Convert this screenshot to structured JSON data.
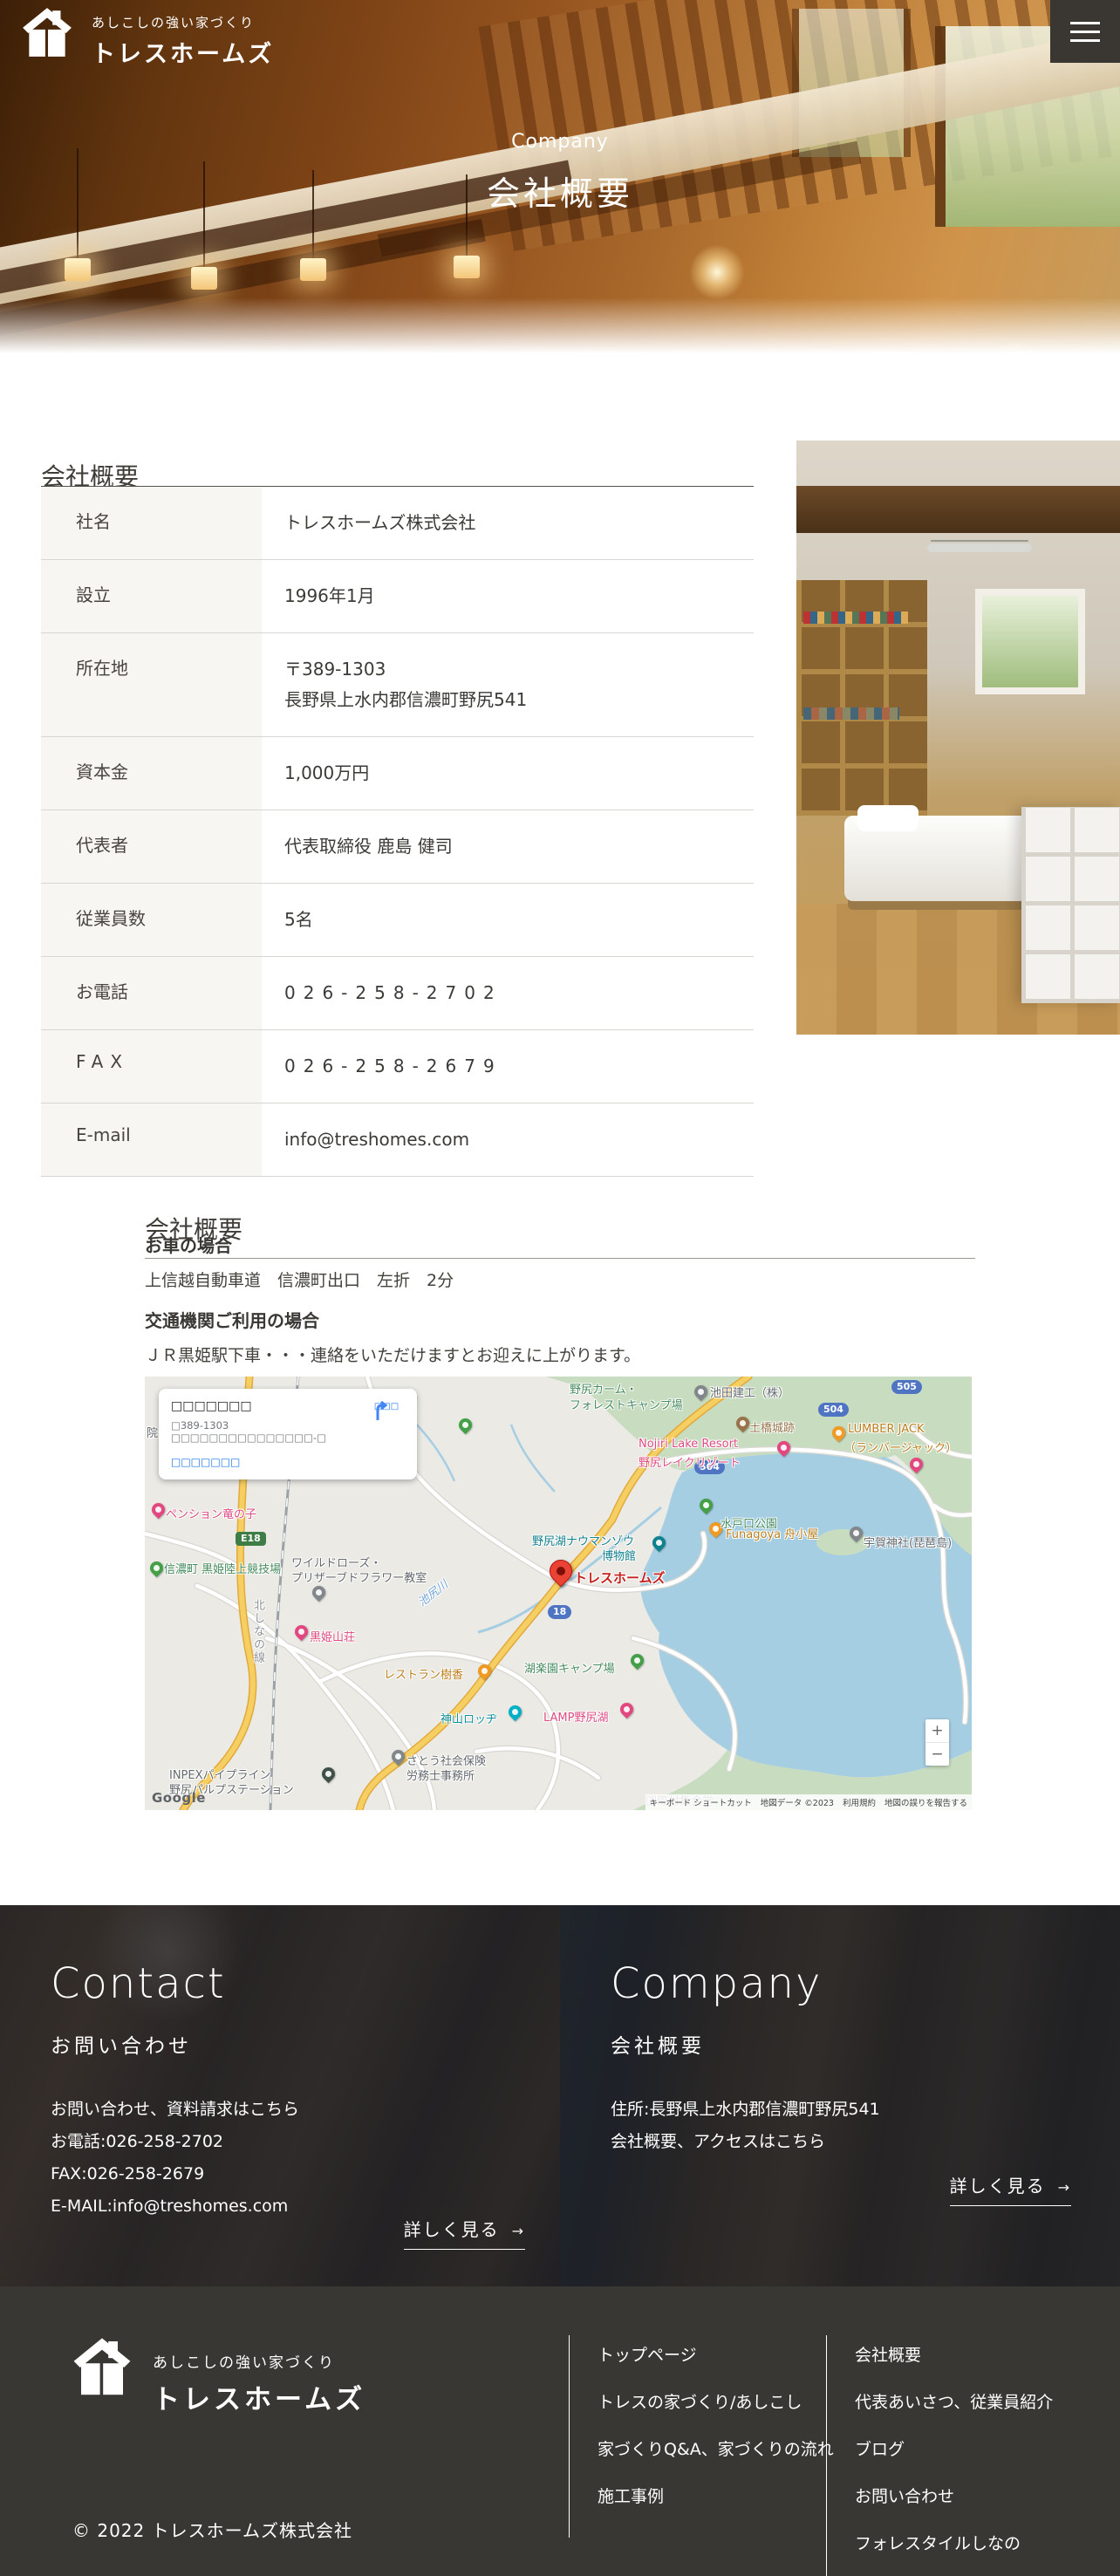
{
  "header": {
    "logo_tagline": "あしこしの強い家づくり",
    "logo_name": "トレスホームズ"
  },
  "hero": {
    "subtitle": "Company",
    "title": "会社概要"
  },
  "company": {
    "heading": "会社概要",
    "rows": [
      {
        "label": "社名",
        "value": "トレスホームズ株式会社"
      },
      {
        "label": "設立",
        "value": "1996年1月"
      },
      {
        "label": "所在地",
        "value": "〒389-1303\n長野県上水内郡信濃町野尻541"
      },
      {
        "label": "資本金",
        "value": "1,000万円"
      },
      {
        "label": "代表者",
        "value": "代表取締役 鹿島 健司"
      },
      {
        "label": "従業員数",
        "value": "5名"
      },
      {
        "label": "お電話",
        "value": "026-258-2702"
      },
      {
        "label": "FAX",
        "value": "026-258-2679"
      },
      {
        "label": "E-mail",
        "value": "info@treshomes.com"
      }
    ]
  },
  "access": {
    "heading": "会社概要",
    "car_title": "お車の場合",
    "car_text": "上信越自動車道　信濃町出口　左折　2分",
    "train_title": "交通機関ご利用の場合",
    "train_text": "ＪＲ黒姫駅下車・・・連絡をいただけますとお迎えに上がります。"
  },
  "map": {
    "info_window": {
      "title": "□□□□□□□",
      "address": "□389-1303 □□□□□□□□□□□□□□□-□",
      "link": "□□□□□□□",
      "directions_label": "□□□"
    },
    "labels": [
      {
        "text": "池田建工（株）"
      },
      {
        "text": "村"
      },
      {
        "text": "野尻カーム・"
      },
      {
        "text": "フォレストキャンプ場"
      },
      {
        "text": "土橋城跡"
      },
      {
        "text": "Nojiri Lake Resort"
      },
      {
        "text": "野尻レイクリゾート"
      },
      {
        "text": "LUMBER JACK"
      },
      {
        "text": "（ランバージャック）"
      },
      {
        "text": "水戸口公園"
      },
      {
        "text": "Funagoya 舟小屋"
      },
      {
        "text": "宇賀神社(琵琶島)"
      },
      {
        "text": "ペンション竜の子"
      },
      {
        "text": "信濃町 黒姫陸上競技場"
      },
      {
        "text": "ワイルドローズ・"
      },
      {
        "text": "プリザーブドフラワー教室"
      },
      {
        "text": "池尻川"
      },
      {
        "text": "黒姫山荘"
      },
      {
        "text": "北しなの線"
      },
      {
        "text": "レストラン樹香"
      },
      {
        "text": "神山ロッヂ"
      },
      {
        "text": "野尻湖ナウマンゾウ"
      },
      {
        "text": "博物館"
      },
      {
        "text": "トレスホームズ"
      },
      {
        "text": "湖楽園キャンプ場"
      },
      {
        "text": "LAMP野尻湖"
      },
      {
        "text": "さとう社会保険"
      },
      {
        "text": "労務士事務所"
      },
      {
        "text": "INPEXパイプライン"
      },
      {
        "text": "野尻パルプステーション"
      },
      {
        "text": "国際村集会堂"
      },
      {
        "text": "院"
      }
    ],
    "shields": {
      "e18": "E18",
      "r18": "18",
      "r504a": "504",
      "r504b": "504",
      "r505": "505"
    },
    "zoom_in": "+",
    "zoom_out": "−",
    "google": "Google",
    "attribution": [
      "キーボード ショートカット",
      "地図データ ©2023",
      "利用規約",
      "地図の誤りを報告する"
    ]
  },
  "footer_cards": {
    "contact": {
      "title": "Contact",
      "subtitle": "お問い合わせ",
      "line1": "お問い合わせ、資料請求はこちら",
      "line2": "お電話:026-258-2702",
      "line3": "FAX:026-258-2679",
      "line4": "E-MAIL:info@treshomes.com",
      "more": "詳しく見る",
      "more_icon": "→"
    },
    "company": {
      "title": "Company",
      "subtitle": "会社概要",
      "line1": "住所:長野県上水内郡信濃町野尻541",
      "line2": "会社概要、アクセスはこちら",
      "more": "詳しく見る",
      "more_icon": "→"
    }
  },
  "footer": {
    "logo_tagline": "あしこしの強い家づくり",
    "logo_name": "トレスホームズ",
    "nav_col1": [
      "トップページ",
      "トレスの家づくり/あしこし",
      "家づくりQ&A、家づくりの流れ",
      "施工事例"
    ],
    "nav_col2": [
      "会社概要",
      "代表あいさつ、従業員紹介",
      "ブログ",
      "お問い合わせ",
      "フォレスタイルしなの"
    ],
    "copyright": "© 2022 トレスホームズ株式会社"
  }
}
